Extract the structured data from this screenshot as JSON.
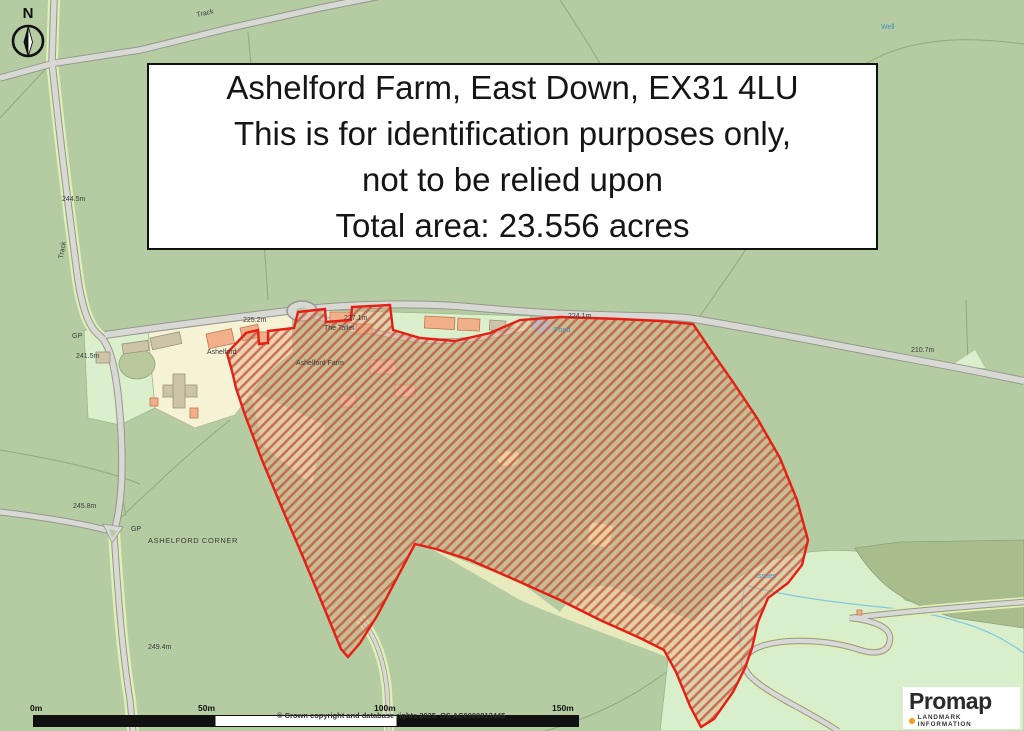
{
  "title_box": {
    "lines": [
      "Ashelford Farm, East Down, EX31 4LU",
      "This is for identification purposes only,",
      "not to be relied upon",
      "Total area: 23.556 acres"
    ]
  },
  "north_arrow": {
    "label": "N"
  },
  "map_labels": [
    {
      "text": "Track",
      "x": 196,
      "y": 12,
      "rot": -12
    },
    {
      "text": "244.5m",
      "x": 62,
      "y": 196,
      "rot": 0
    },
    {
      "text": "Track",
      "x": 58,
      "y": 258,
      "rot": -80
    },
    {
      "text": "GP",
      "x": 72,
      "y": 333,
      "rot": 0
    },
    {
      "text": "241.5m",
      "x": 76,
      "y": 353,
      "rot": 0
    },
    {
      "text": "225.2m",
      "x": 243,
      "y": 317,
      "rot": 0
    },
    {
      "text": "227.1m",
      "x": 344,
      "y": 315,
      "rot": 0
    },
    {
      "text": "The Tallet",
      "x": 324,
      "y": 325,
      "rot": 0
    },
    {
      "text": "Ashelford",
      "x": 207,
      "y": 349,
      "rot": 0
    },
    {
      "text": "Ashelford Farm",
      "x": 296,
      "y": 360,
      "rot": 0
    },
    {
      "text": "224.1m",
      "x": 568,
      "y": 313,
      "rot": 0
    },
    {
      "text": "Pond",
      "x": 554,
      "y": 327,
      "rot": 0,
      "color": "#4a8fc0"
    },
    {
      "text": "Well",
      "x": 881,
      "y": 24,
      "rot": 0,
      "color": "#4a8fc0"
    },
    {
      "text": "210.7m",
      "x": 911,
      "y": 347,
      "rot": 0
    },
    {
      "text": "245.8m",
      "x": 73,
      "y": 503,
      "rot": 0
    },
    {
      "text": "GP",
      "x": 131,
      "y": 526,
      "rot": 0
    },
    {
      "text": "ASHELFORD CORNER",
      "x": 148,
      "y": 536,
      "rot": 0,
      "size": 7.5,
      "spacing": 0.6
    },
    {
      "text": "249.4m",
      "x": 148,
      "y": 644,
      "rot": 0
    },
    {
      "text": "Issues",
      "x": 756,
      "y": 573,
      "rot": 0,
      "color": "#4a8fc0"
    }
  ],
  "scale_bar": {
    "ticks": [
      "0m",
      "50m",
      "100m",
      "150m"
    ]
  },
  "copyright": "© Crown copyright and database rights 2025. OS AC0000813445",
  "logo": {
    "brand": "Promap",
    "subtitle": "LANDMARK INFORMATION"
  },
  "legend_colors": {
    "boundary_red": "#e61e14",
    "field_green": "#b5cba1",
    "rough_pasture_mint": "#d9eecb",
    "woodland_olive": "#a9bc8b",
    "building_orange": "#f1b089",
    "water_blue": "#9cc7ee"
  }
}
